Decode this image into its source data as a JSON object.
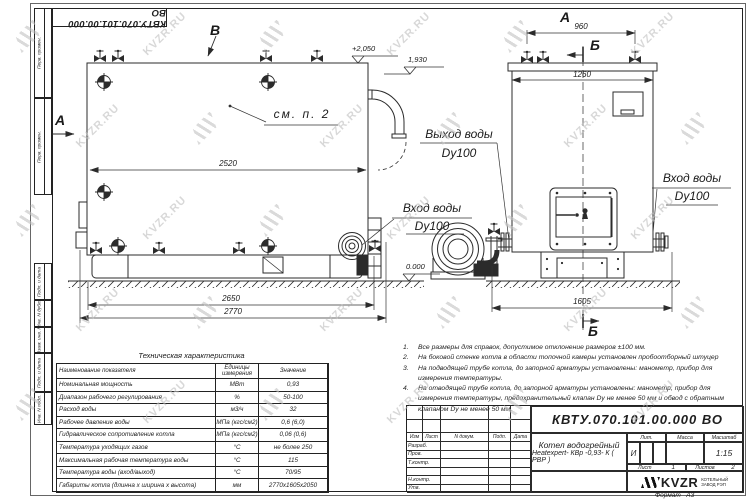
{
  "doc": {
    "number": "КВТУ.070.101.00.000  ВО",
    "format_label": "Формат",
    "format_value": "А3"
  },
  "strip": {
    "top": [
      "Перв. примен.",
      "Перв. примен."
    ],
    "bottom": [
      "Подп. и дата",
      "Инв. N дубл.",
      "Взам. инв. N",
      "Подп. и дата",
      "Инв. N подл."
    ]
  },
  "views": {
    "view_b_label": "В",
    "section_a_label": "А",
    "view_a_label": "А",
    "section_b_top": "Б",
    "section_b_bottom": "Б",
    "callout_see_note": "см. п. 2",
    "outlet_line1": "Выход воды",
    "outlet_line2": "Dy100",
    "inlet_left_line1": "Вход воды",
    "inlet_left_line2": "Dy100",
    "inlet_right_line1": "Вход воды",
    "inlet_right_line2": "Dy100",
    "elev_top": "+2,050",
    "elev_mid": "1,930",
    "elev_zero": "0.000",
    "dims": {
      "d2520": "2520",
      "d2650": "2650",
      "d2770": "2770",
      "d960": "960",
      "d1260": "1260",
      "d1605": "1605"
    }
  },
  "table": {
    "title": "Техническая характеристика",
    "headers": [
      "Наименование показателя",
      "Единицы измерения",
      "Значение"
    ],
    "rows": [
      [
        "Номинальная мощность",
        "МВт",
        "0,93"
      ],
      [
        "Диапазон рабочего регулирования",
        "%",
        "50-100"
      ],
      [
        "Расход воды",
        "м3/ч",
        "32"
      ],
      [
        "Рабочее давление воды",
        "МПа (кгс/см2)",
        "0,6 (6,0)"
      ],
      [
        "Гидравлическое сопротивление котла",
        "МПа (кгс/см2)",
        "0,06 (0,6)"
      ],
      [
        "Температура уходящих газов",
        "°С",
        "не более 250"
      ],
      [
        "Максимальная рабочая температура воды",
        "°С",
        "115"
      ],
      [
        "Температура воды (вход/выход)",
        "°С",
        "70/95"
      ],
      [
        "Габариты котла (длинна х ширина х высота)",
        "мм",
        "2770х1605х2050"
      ]
    ]
  },
  "notes": [
    {
      "n": "1.",
      "text": "Все размеры для справок, допустимое отклонение размеров ±100 мм."
    },
    {
      "n": "2.",
      "text": "На боковой стенке котла в области топочной камеры установлен пробоотборный штуцер"
    },
    {
      "n": "3.",
      "text": "На подводящей трубе котла, до запорной арматуры установлены: манометр, прибор для измерения температуры."
    },
    {
      "n": "4.",
      "text": "На отводящей трубе котла, до запорной арматуры установлены: манометр, прибор для измерения температуры, предохранительный клапан Dу не менее 50 мм и обвод с обратным клапаном Dу не менее 50 мм."
    }
  ],
  "titleblock": {
    "number": "КВТУ.070.101.00.000  ВО",
    "header_cols": [
      "Изм",
      "Лист",
      "N докум.",
      "Подп.",
      "Дата"
    ],
    "staff_rows": [
      "Разраб.",
      "Пров.",
      "Т.контр.",
      "",
      "Н.контр.",
      "Утв."
    ],
    "name_line1": "Котел водогрейный",
    "name_line2": "Heatexpert- КВр -0,93- К ( РВР )",
    "lit_label": "Лит.",
    "mass_label": "Масса",
    "scale_label": "Масштаб",
    "lit_value": "И",
    "scale_value": "1:15",
    "sheet_label": "Лист",
    "sheet_value": "1",
    "sheets_label": "Листов",
    "sheets_value": "2",
    "logo_text": "KVZR",
    "logo_sub1": "КОТЕЛЬНЫЙ",
    "logo_sub2": "ЗАВОД РЭП"
  },
  "watermark": {
    "text": "KVZR.RU"
  }
}
